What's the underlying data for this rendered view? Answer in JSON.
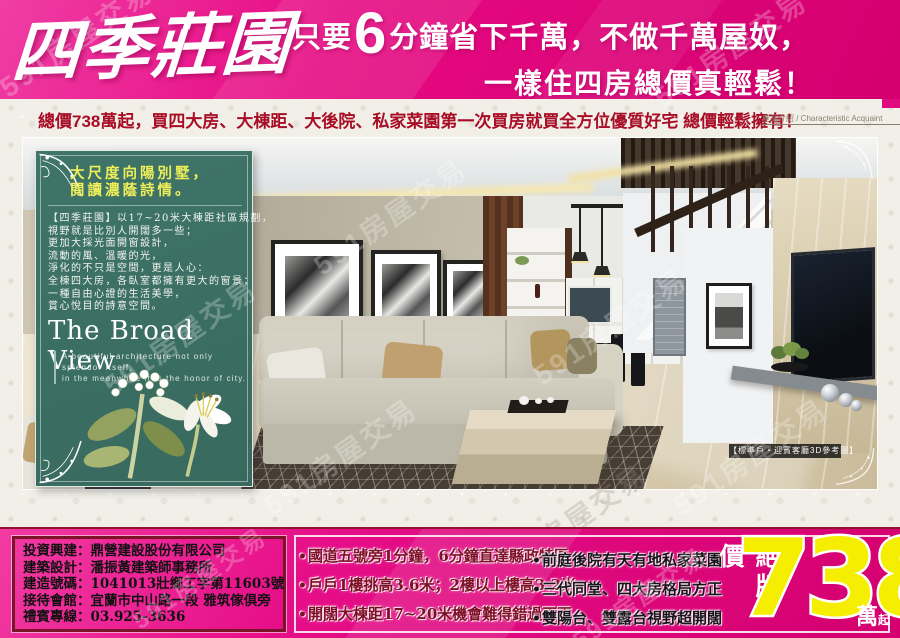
{
  "header": {
    "title": "四季莊園",
    "slogan_prefix": "只要",
    "slogan_big": "6",
    "slogan_line1": "分鐘省下千萬，不做千萬屋奴，",
    "slogan_line2": "一樣住四房總價真輕鬆！"
  },
  "subheader": {
    "text": "總價738萬起，買四大房、大棟距、大後院、私家菜園第一次買房就買全方位優質好宅 總價輕鬆擁有！",
    "section_label": "產品介紹 / Characteristic Acquaint"
  },
  "hero": {
    "panel": {
      "headline_line1": "大尺度向陽別墅，",
      "headline_line2": "閱讀濃蔭詩情。",
      "body_lines": [
        "【四季莊園】以17~20米大棟距社區規劃，",
        "視野就是比別人開闊多一些；",
        "更加大採光面開窗設計，",
        "流動的風、溫暖的光，",
        "淨化的不只是空間，更是人心：",
        "全棟四大房，各臥室都擁有更大的窗景；",
        "一種自由心證的生活美學，",
        "賞心悅目的詩意空間。"
      ],
      "english_title": "The Broad View",
      "english_caption_line1": "A beautiful architecture not only splendor itself,",
      "english_caption_line2": "in the meanwhile it is the honor of city."
    },
    "photo_caption": "【標準戶‧迎賓客廳3D參考圖】"
  },
  "watermark": "591房屋交易",
  "footer": {
    "bullet_char": "•",
    "company_lines": [
      "投資興建：鼎營建設股份有限公司",
      "建築設計：潘振黃建築師事務所",
      "建造號碼：1041013壯鄉工字第11603號",
      "接待會館：宜蘭市中山路一段 雅筑傢俱旁",
      "禮賓專線：03.925-3636"
    ],
    "features_left": [
      "國道五號旁1分鐘，6分鐘直達縣政特區",
      "戶戶1樓挑高3.6米；2樓以上樓高3.2米",
      "開闊大棟距17~20米機會難得錯過不再"
    ],
    "features_right": [
      "前庭後院有天有地私家菜園",
      "三代同堂、四大房格局方正",
      "雙陽台、雙露台視野超開闊"
    ],
    "price": {
      "label": "絕版價",
      "value": "738",
      "unit_big": "萬",
      "unit_small": "起"
    }
  },
  "colors": {
    "accent_magenta": "#e60982",
    "deep_magenta": "#d4006f",
    "maroon_border": "#7b1426",
    "panel_green": "#3b7065",
    "headline_yellow": "#edee58",
    "price_yellow": "#f6ee00",
    "strip_red": "#a80d26"
  }
}
